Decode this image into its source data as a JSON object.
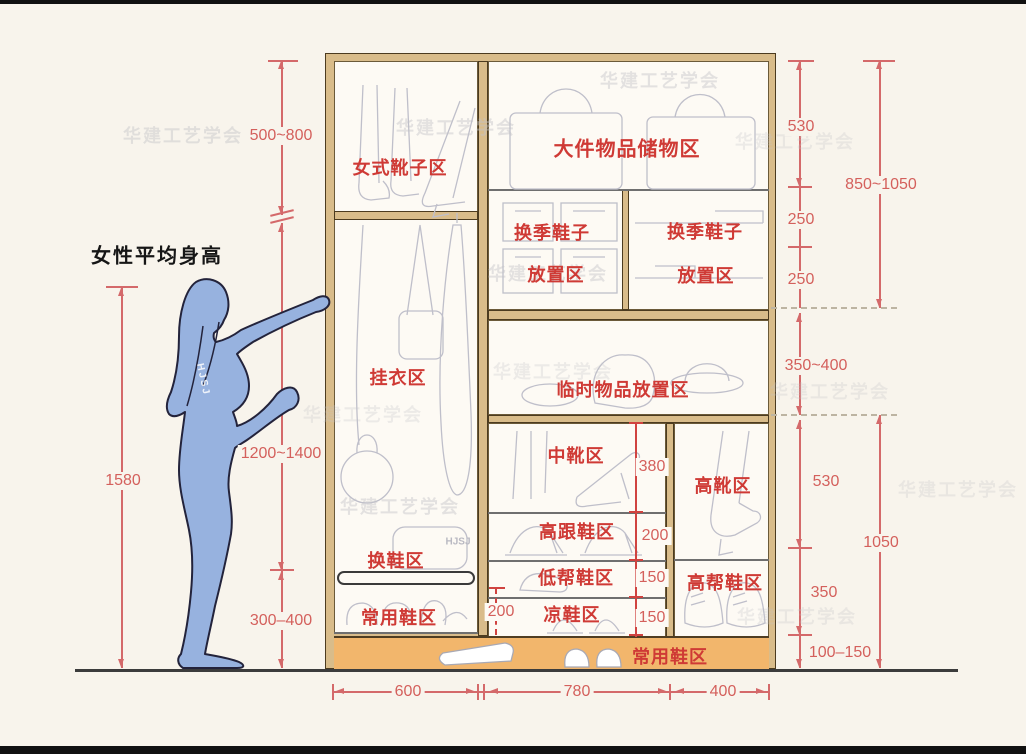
{
  "colors": {
    "bg": "#f8f4ec",
    "panel": "#fdfaf4",
    "wood": "#d9bc8a",
    "wood_edge": "#4c3b1f",
    "orange": "#f2b66c",
    "red_label": "#cf3a35",
    "dim": "#d4696a",
    "dim_text": "#d4605c",
    "sketch": "#bfbfca",
    "figure_fill": "#97b2df",
    "figure_edge": "#23233b",
    "ground": "#3c3c3c",
    "watermark": "#c4c4c8"
  },
  "figure": {
    "caption": "女性平均身高"
  },
  "brand": {
    "text": "HJSJ"
  },
  "watermark": {
    "text": "华建工艺学会"
  },
  "zones": {
    "women_boots": "女式靴子区",
    "large_items": "大件物品储物区",
    "seasonal_left_1": "换季鞋子",
    "seasonal_left_2": "放置区",
    "seasonal_right_1": "换季鞋子",
    "seasonal_right_2": "放置区",
    "hanging": "挂衣区",
    "temporary": "临时物品放置区",
    "mid_boots": "中靴区",
    "high_boots": "高靴区",
    "high_heels": "高跟鞋区",
    "low_shoes": "低帮鞋区",
    "sandals": "凉鞋区",
    "hightop_shoes": "高帮鞋区",
    "shoe_change": "换鞋区",
    "common_left": "常用鞋区",
    "common_bottom": "常用鞋区"
  },
  "dims": {
    "boots_zone": "500~800",
    "hanging_zone": "1200~1400",
    "change_zone": "300–400",
    "stature": "1580",
    "storage": "530",
    "seasonal_a": "250",
    "seasonal_b": "250",
    "upper_total": "850~1050",
    "temp_zone": "350~400",
    "boots_col": "530",
    "hightop_col": "350",
    "lower_total": "1050",
    "base": "100–150",
    "mid_boot": "380",
    "heel": "200",
    "low": "150",
    "sandal": "150",
    "depth": "200",
    "width_left": "600",
    "width_middle": "780",
    "width_right": "400"
  }
}
